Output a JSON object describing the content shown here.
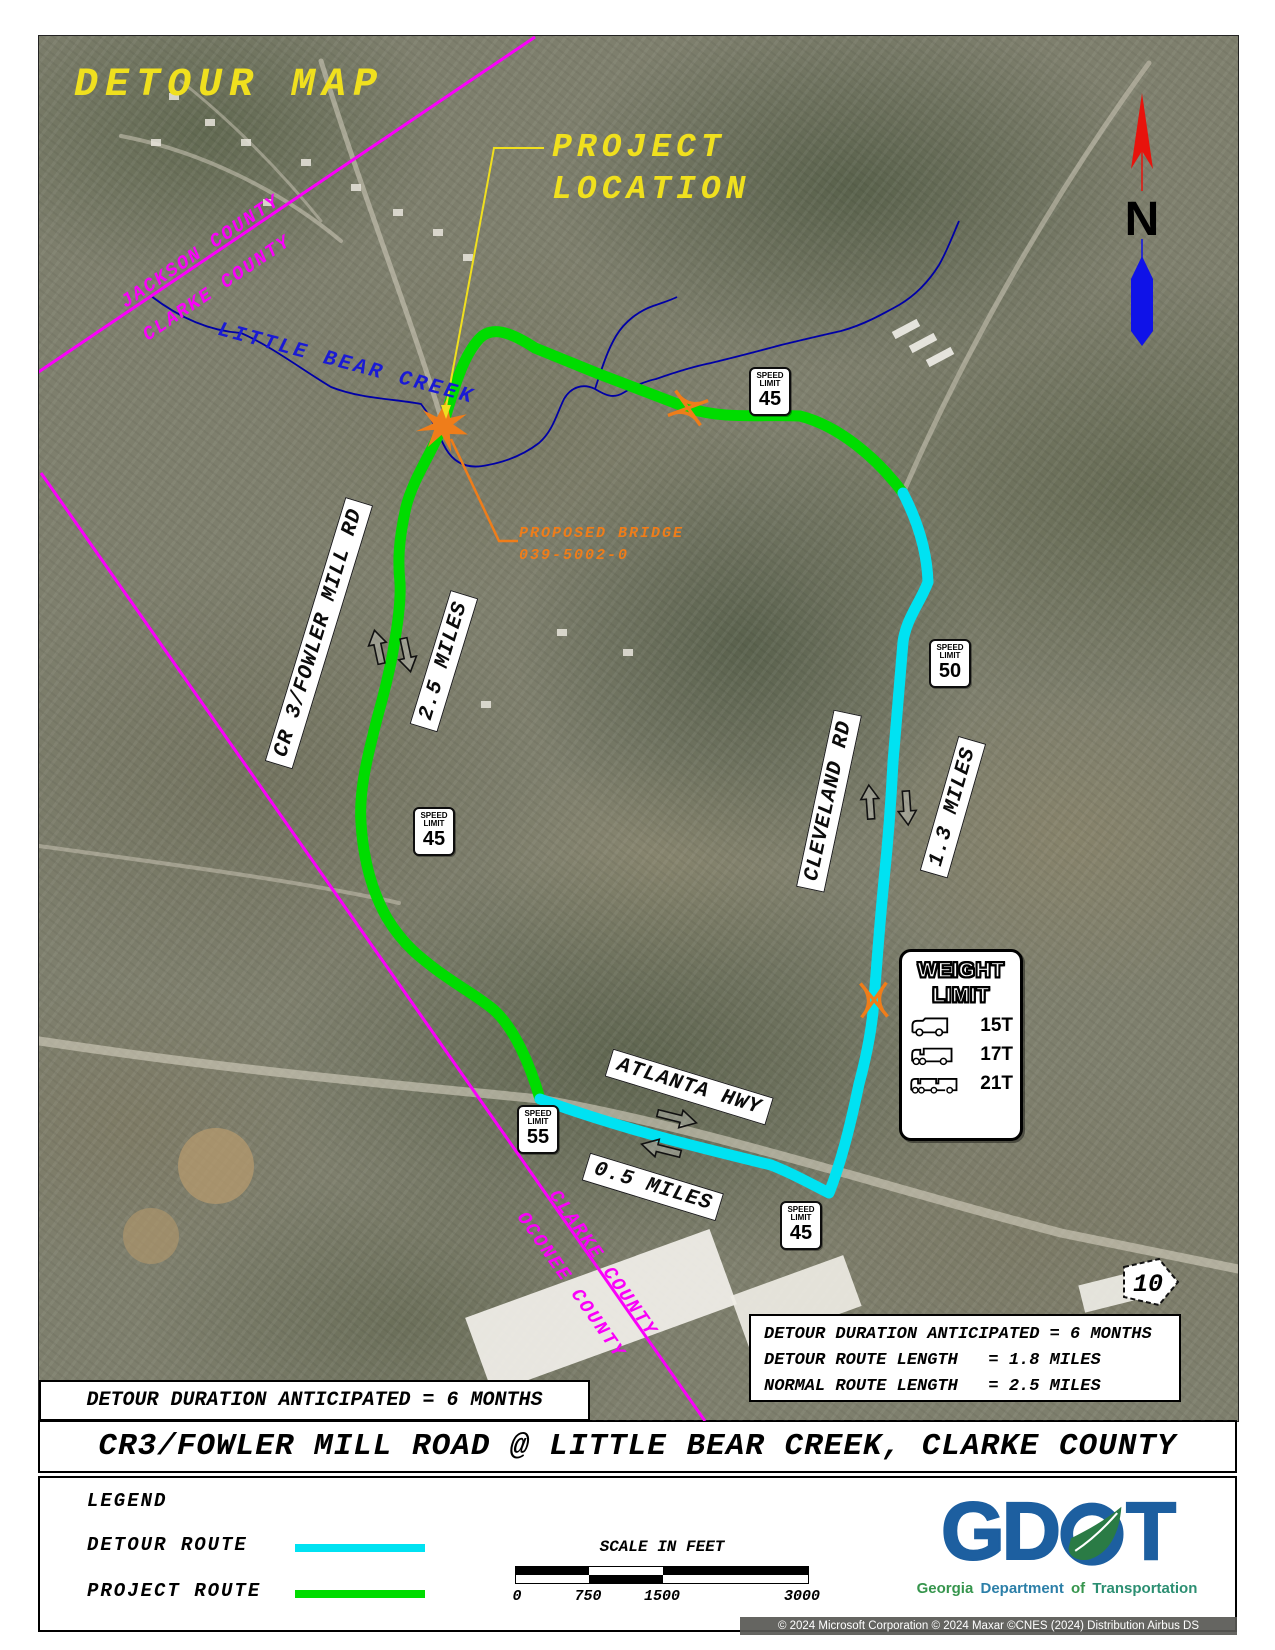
{
  "colors": {
    "detour_route_cyan": "#00e2f2",
    "project_route_green": "#00dc00",
    "county_line_magenta": "#fa00fa",
    "annotation_yellow": "#f0e01e",
    "bridge_orange": "#ef7d1a",
    "creek_blue": "#1a1ad4",
    "logo_blue": "#1d5fa0",
    "logo_green": "#2a7b45"
  },
  "map": {
    "title": "DETOUR MAP",
    "project_location": {
      "line1": "PROJECT",
      "line2": "LOCATION"
    },
    "county_labels": {
      "jackson": "JACKSON COUNTY",
      "clarke_top": "CLARKE COUNTY",
      "clarke_bottom": "CLARKE COUNTY",
      "oconee": "OCONEE COUNTY"
    },
    "creek_label": "LITTLE BEAR CREEK",
    "bridge_label": {
      "line1": "PROPOSED BRIDGE",
      "line2": "039-5002-0"
    },
    "road_labels": {
      "fowler": "CR 3/FOWLER MILL RD",
      "cleveland": "CLEVELAND RD",
      "atlanta": "ATLANTA HWY"
    },
    "distance_labels": {
      "fowler": "2.5 MILES",
      "cleveland": "1.3 MILES",
      "atlanta": "0.5 MILES"
    },
    "speed_sign_text": {
      "line1": "SPEED",
      "line2": "LIMIT"
    },
    "speed_signs": {
      "fowler_north": "45",
      "cleveland_north": "50",
      "fowler_mid": "45",
      "atlanta_west": "55",
      "atlanta_east": "45"
    },
    "weight_sign": {
      "line1": "WEIGHT",
      "line2": "LIMIT",
      "rows": [
        {
          "icon": "box-truck-icon",
          "weight": "15T"
        },
        {
          "icon": "semi-truck-icon",
          "weight": "17T"
        },
        {
          "icon": "double-trailer-truck-icon",
          "weight": "21T"
        }
      ]
    },
    "north_arrow_label": "N",
    "route_marker": "10",
    "duration_note": "DETOUR DURATION ANTICIPATED = 6 MONTHS",
    "detour_info": {
      "line1": "DETOUR DURATION ANTICIPATED = 6 MONTHS",
      "line2": "DETOUR ROUTE LENGTH   = 1.8 MILES",
      "line3": "NORMAL ROUTE LENGTH   = 2.5 MILES"
    }
  },
  "title_bar": {
    "text": "CR3/FOWLER MILL ROAD @ LITTLE BEAR CREEK, CLARKE COUNTY"
  },
  "legend": {
    "heading": "LEGEND",
    "items": [
      {
        "label": "DETOUR ROUTE",
        "color": "#00e2f2"
      },
      {
        "label": "PROJECT ROUTE",
        "color": "#00dc00"
      }
    ]
  },
  "scale_bar": {
    "title": "SCALE IN FEET",
    "ticks": [
      "0",
      "750",
      "1500",
      "3000"
    ]
  },
  "logo": {
    "g": "G",
    "d": "D",
    "t": "T",
    "tagline": {
      "georgia": "Georgia",
      "department": "Department",
      "of": "of",
      "transportation": "Transportation"
    }
  },
  "credits": "© 2024 Microsoft Corporation  © 2024 Maxar  ©CNES (2024) Distribution Airbus DS"
}
